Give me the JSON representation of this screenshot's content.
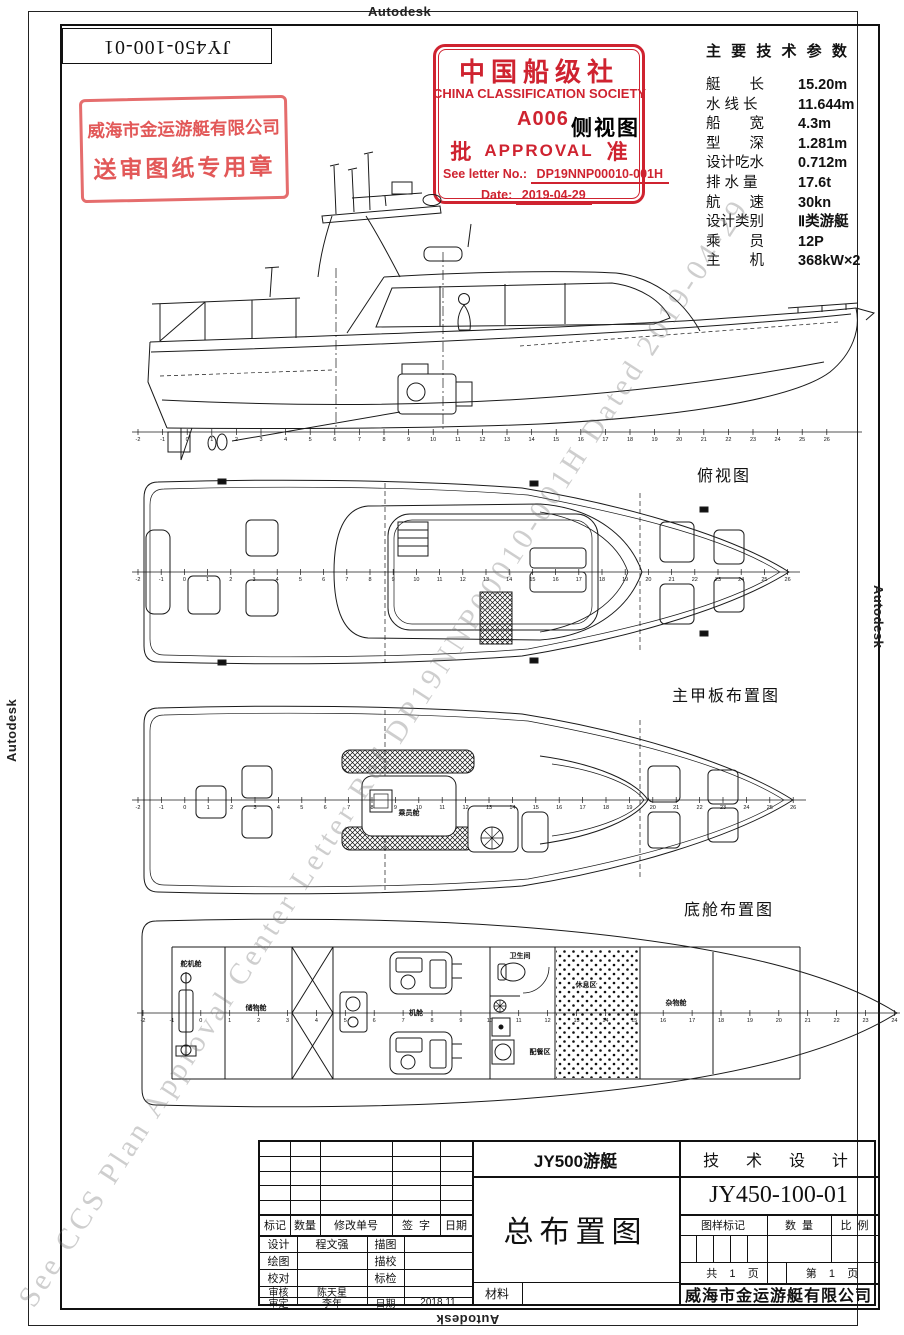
{
  "page": {
    "autodesk": "Autodesk",
    "sheet_no": "JY450-100-01",
    "watermark": "See CCS Plan Approval Center Letter Ref DP19NNP00010-001H Dated 2019-04-29"
  },
  "company_stamp": {
    "line1": "威海市金运游艇有限公司",
    "line2": "送审图纸专用章"
  },
  "ccs_stamp": {
    "cn": "中国船级社",
    "en": "CHINA CLASSIFICATION SOCIETY",
    "code": "A006",
    "approve_left": "批",
    "approve_mid": "APPROVAL",
    "approve_right": "准",
    "letter_label": "See letter No.:",
    "letter_no": "DP19NNP00010-001H",
    "date_label": "Date:",
    "date": "2019-04-29"
  },
  "tech_params": {
    "title": "主 要 技 术 参 数",
    "rows": [
      {
        "label": "艇　　长",
        "value": "15.20m"
      },
      {
        "label": "水 线 长",
        "value": "11.644m"
      },
      {
        "label": "船　　宽",
        "value": "4.3m"
      },
      {
        "label": "型　　深",
        "value": "1.281m"
      },
      {
        "label": "设计吃水",
        "value": "0.712m"
      },
      {
        "label": "排 水 量",
        "value": "17.6t"
      },
      {
        "label": "航　　速",
        "value": "30kn"
      },
      {
        "label": "设计类别",
        "value": "Ⅱ类游艇"
      },
      {
        "label": "乘　　员",
        "value": "12P"
      },
      {
        "label": "主　　机",
        "value": "368kW×2"
      }
    ]
  },
  "views": {
    "side": {
      "title": "侧视图"
    },
    "top": {
      "title": "俯视图"
    },
    "main_deck": {
      "title": "主甲板布置图",
      "cabin": "乘员舱"
    },
    "bilge": {
      "title": "底舱布置图",
      "steering": "舵机舱",
      "storage": "储物舱",
      "engine_room": "机舱",
      "toilet": "卫生间",
      "galley": "配餐区",
      "rest": "休息区",
      "misc": "杂物舱"
    }
  },
  "stations": {
    "side": {
      "from": -2,
      "to": 26
    },
    "top": {
      "from": -2,
      "to": 26
    },
    "main_deck": {
      "from": -2,
      "to": 26
    },
    "bilge": {
      "from": -2,
      "to": 24
    }
  },
  "title_block": {
    "rev_headers": [
      "标记",
      "数量",
      "修改单号",
      "签  字",
      "日期"
    ],
    "rows": [
      {
        "c1": "设计",
        "c2": "程文强",
        "c3": "描图",
        "c4": ""
      },
      {
        "c1": "绘图",
        "c2": "",
        "c3": "描校",
        "c4": ""
      },
      {
        "c1": "校对",
        "c2": "",
        "c3": "标检",
        "c4": ""
      },
      {
        "c1": "审核",
        "c2": "陈天星",
        "c3": "",
        "c4": ""
      },
      {
        "c1": "审定",
        "c2": "李年",
        "c3": "日期",
        "c4": "2018.11"
      }
    ],
    "material": "材料",
    "project": "JY500游艇",
    "drawing_title": "总布置图",
    "stage": "技  术  设  计",
    "drawing_no": "JY450-100-01",
    "col_mark": "图样标记",
    "col_qty": "数  量",
    "col_scale": "比  例",
    "pages_left": "共    1    页",
    "pages_right": "第    1    页",
    "company": "威海市金运游艇有限公司"
  }
}
